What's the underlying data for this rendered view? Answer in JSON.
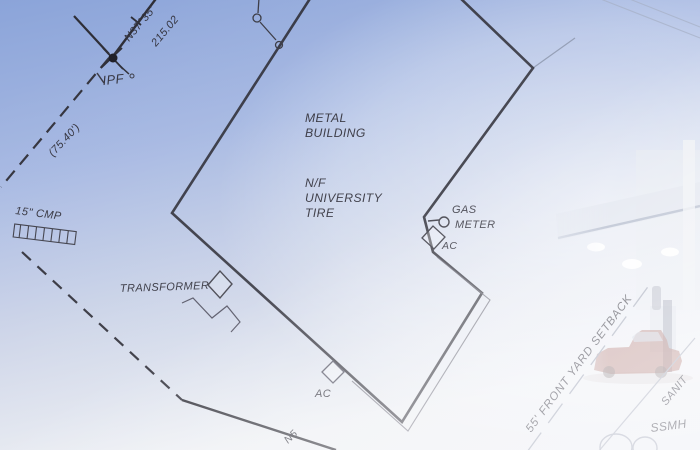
{
  "document": {
    "kind": "survey-site-plan-over-photo"
  },
  "labels": {
    "bearing_top": "N37°35'",
    "distance_top": "215.02",
    "ipf": "IPF",
    "left_dimension": "(75.40')",
    "culvert": "15\" CMP",
    "building": {
      "line1": "METAL",
      "line2": "BUILDING"
    },
    "owner": {
      "line1": "N/F",
      "line2": "UNIVERSITY",
      "line3": "TIRE"
    },
    "gas_meter": {
      "line1": "GAS",
      "line2": "METER"
    },
    "ac_upper": "AC",
    "transformer": "TRANSFORMER",
    "ac_lower": "AC",
    "bearing_bottom_partial": "N5",
    "setback": "55' FRONT YARD SETBACK",
    "sanitary_partial": "SANIT",
    "manhole": "SSMH"
  },
  "colors": {
    "background_top_left": "#8ba4d9",
    "background_bottom": "#edeff3",
    "line_dark": "#2e2e37",
    "line_thin": "#4a4a55",
    "line_faint": "#9aa1b2",
    "text_dark": "#34343f",
    "text_faded": "#9298a8",
    "photo_car": "#a05a50",
    "photo_canopy": "#dde2ec"
  }
}
